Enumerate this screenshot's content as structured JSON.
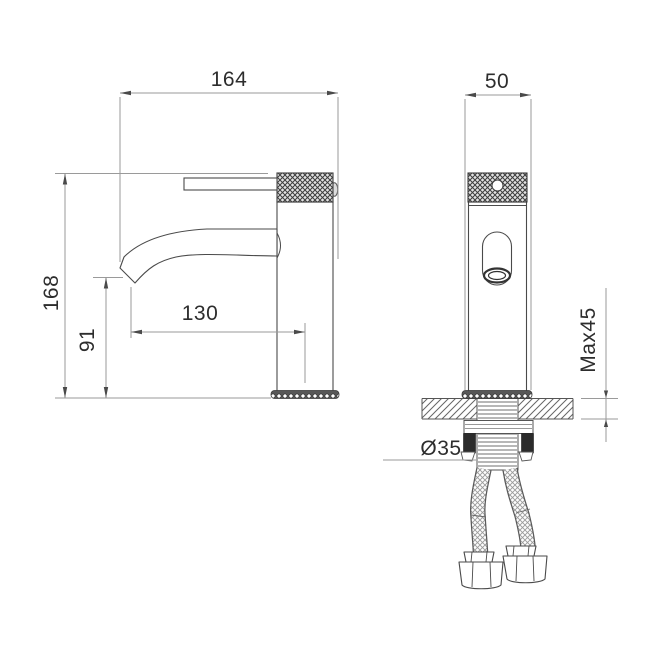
{
  "drawing_type": "faucet-installation-dimension-drawing",
  "dimensions": {
    "overall_length": "164",
    "body_width": "50",
    "overall_height": "168",
    "spout_height": "91",
    "spout_reach": "130",
    "max_deck_thickness": "Max45",
    "mounting_hole_diameter": "Ø35"
  },
  "colors": {
    "background": "#ffffff",
    "object_line": "#4a4a4a",
    "dimension_line": "#9a9a9a",
    "text": "#2d2d2d",
    "gasket_fill": "#2b2b2b"
  }
}
